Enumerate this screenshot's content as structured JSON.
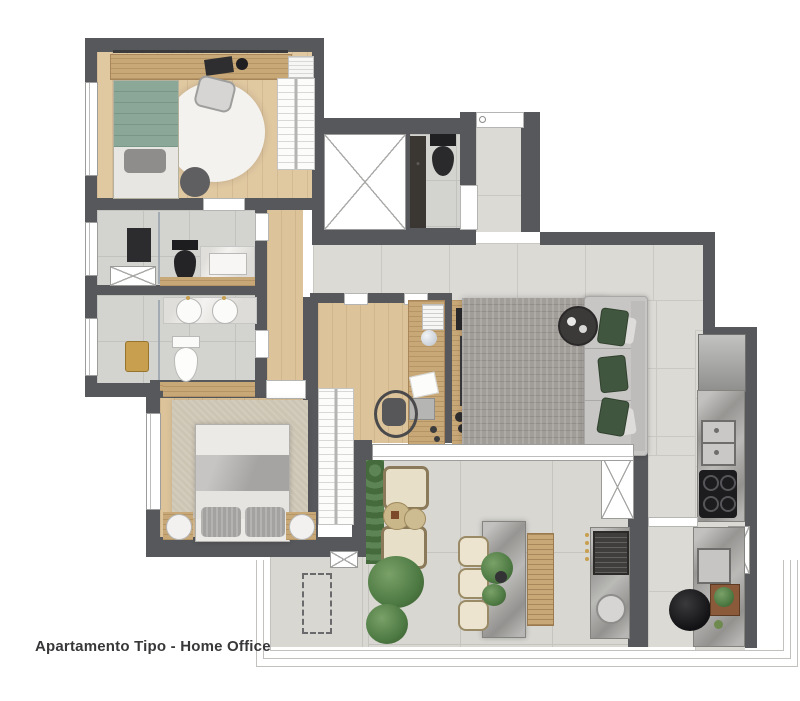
{
  "title": "Apartamento Tipo - Home Office",
  "palette": {
    "wall": "#57585c",
    "wood_floor": "#e0c8a1",
    "tile_floor": "#dbdad5",
    "terrace_tile": "#d8d7d2",
    "rug_gray": "#a19d98",
    "rug_beige": "#cdc5b4",
    "sofa": "#c7c6c4",
    "pillow_green": "#40563e",
    "bed_green": "#8ba797",
    "gold": "#c79f4e",
    "marble": "#a7a6a3",
    "black_fixture": "#242426",
    "text": "#38383a"
  },
  "rooms": [
    "home-office-bedroom",
    "bathroom-suite-1",
    "bathroom-suite-2",
    "corridor",
    "elevator-shaft",
    "lavabo",
    "entry-hall",
    "home-office",
    "living-room",
    "master-bedroom",
    "kitchen",
    "gourmet-terrace"
  ],
  "furniture": [
    "single-bed",
    "desk",
    "desk-chair",
    "round-rug",
    "pouf",
    "wardrobe",
    "linen-stack",
    "black-toilet",
    "white-toilet",
    "double-sink-vanity",
    "shower",
    "gold-stool",
    "double-bed",
    "nightstands",
    "dresser",
    "office-desk",
    "office-chair",
    "laptop",
    "console",
    "sofa",
    "coffee-table",
    "area-rug",
    "fridge",
    "kitchen-sink",
    "cooktop",
    "bbq-grill",
    "grill-sink",
    "dining-table",
    "dining-bench",
    "dining-chairs",
    "lounge-chairs",
    "side-tables",
    "palm-plants",
    "hedge",
    "planter-box",
    "railing"
  ]
}
